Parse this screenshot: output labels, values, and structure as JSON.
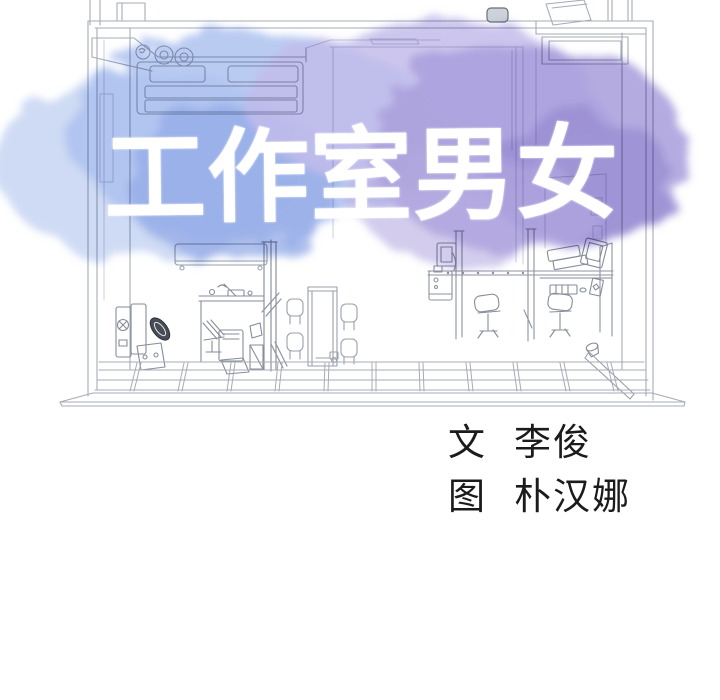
{
  "title": {
    "text": "工作室男女",
    "color": "#ffffff"
  },
  "credits": {
    "writer_label": "文",
    "writer_name": "李俊",
    "artist_label": "图",
    "artist_name": "朴汉娜",
    "text_color": "#1b1b1b"
  },
  "artwork": {
    "scene": "studio-interior-cutaway-line-drawing",
    "line_color": "#a6abb6",
    "faint_line_color": "#ccd1db",
    "dark_line_color": "#8186922",
    "watercolor_colors": {
      "light_blue": "#c7d5f2",
      "blue": "#a9beee",
      "deep_blue": "#8ea5e6",
      "lavender": "#bfb8ea",
      "purple": "#a79cdc",
      "deep_purple": "#9285cf"
    }
  }
}
